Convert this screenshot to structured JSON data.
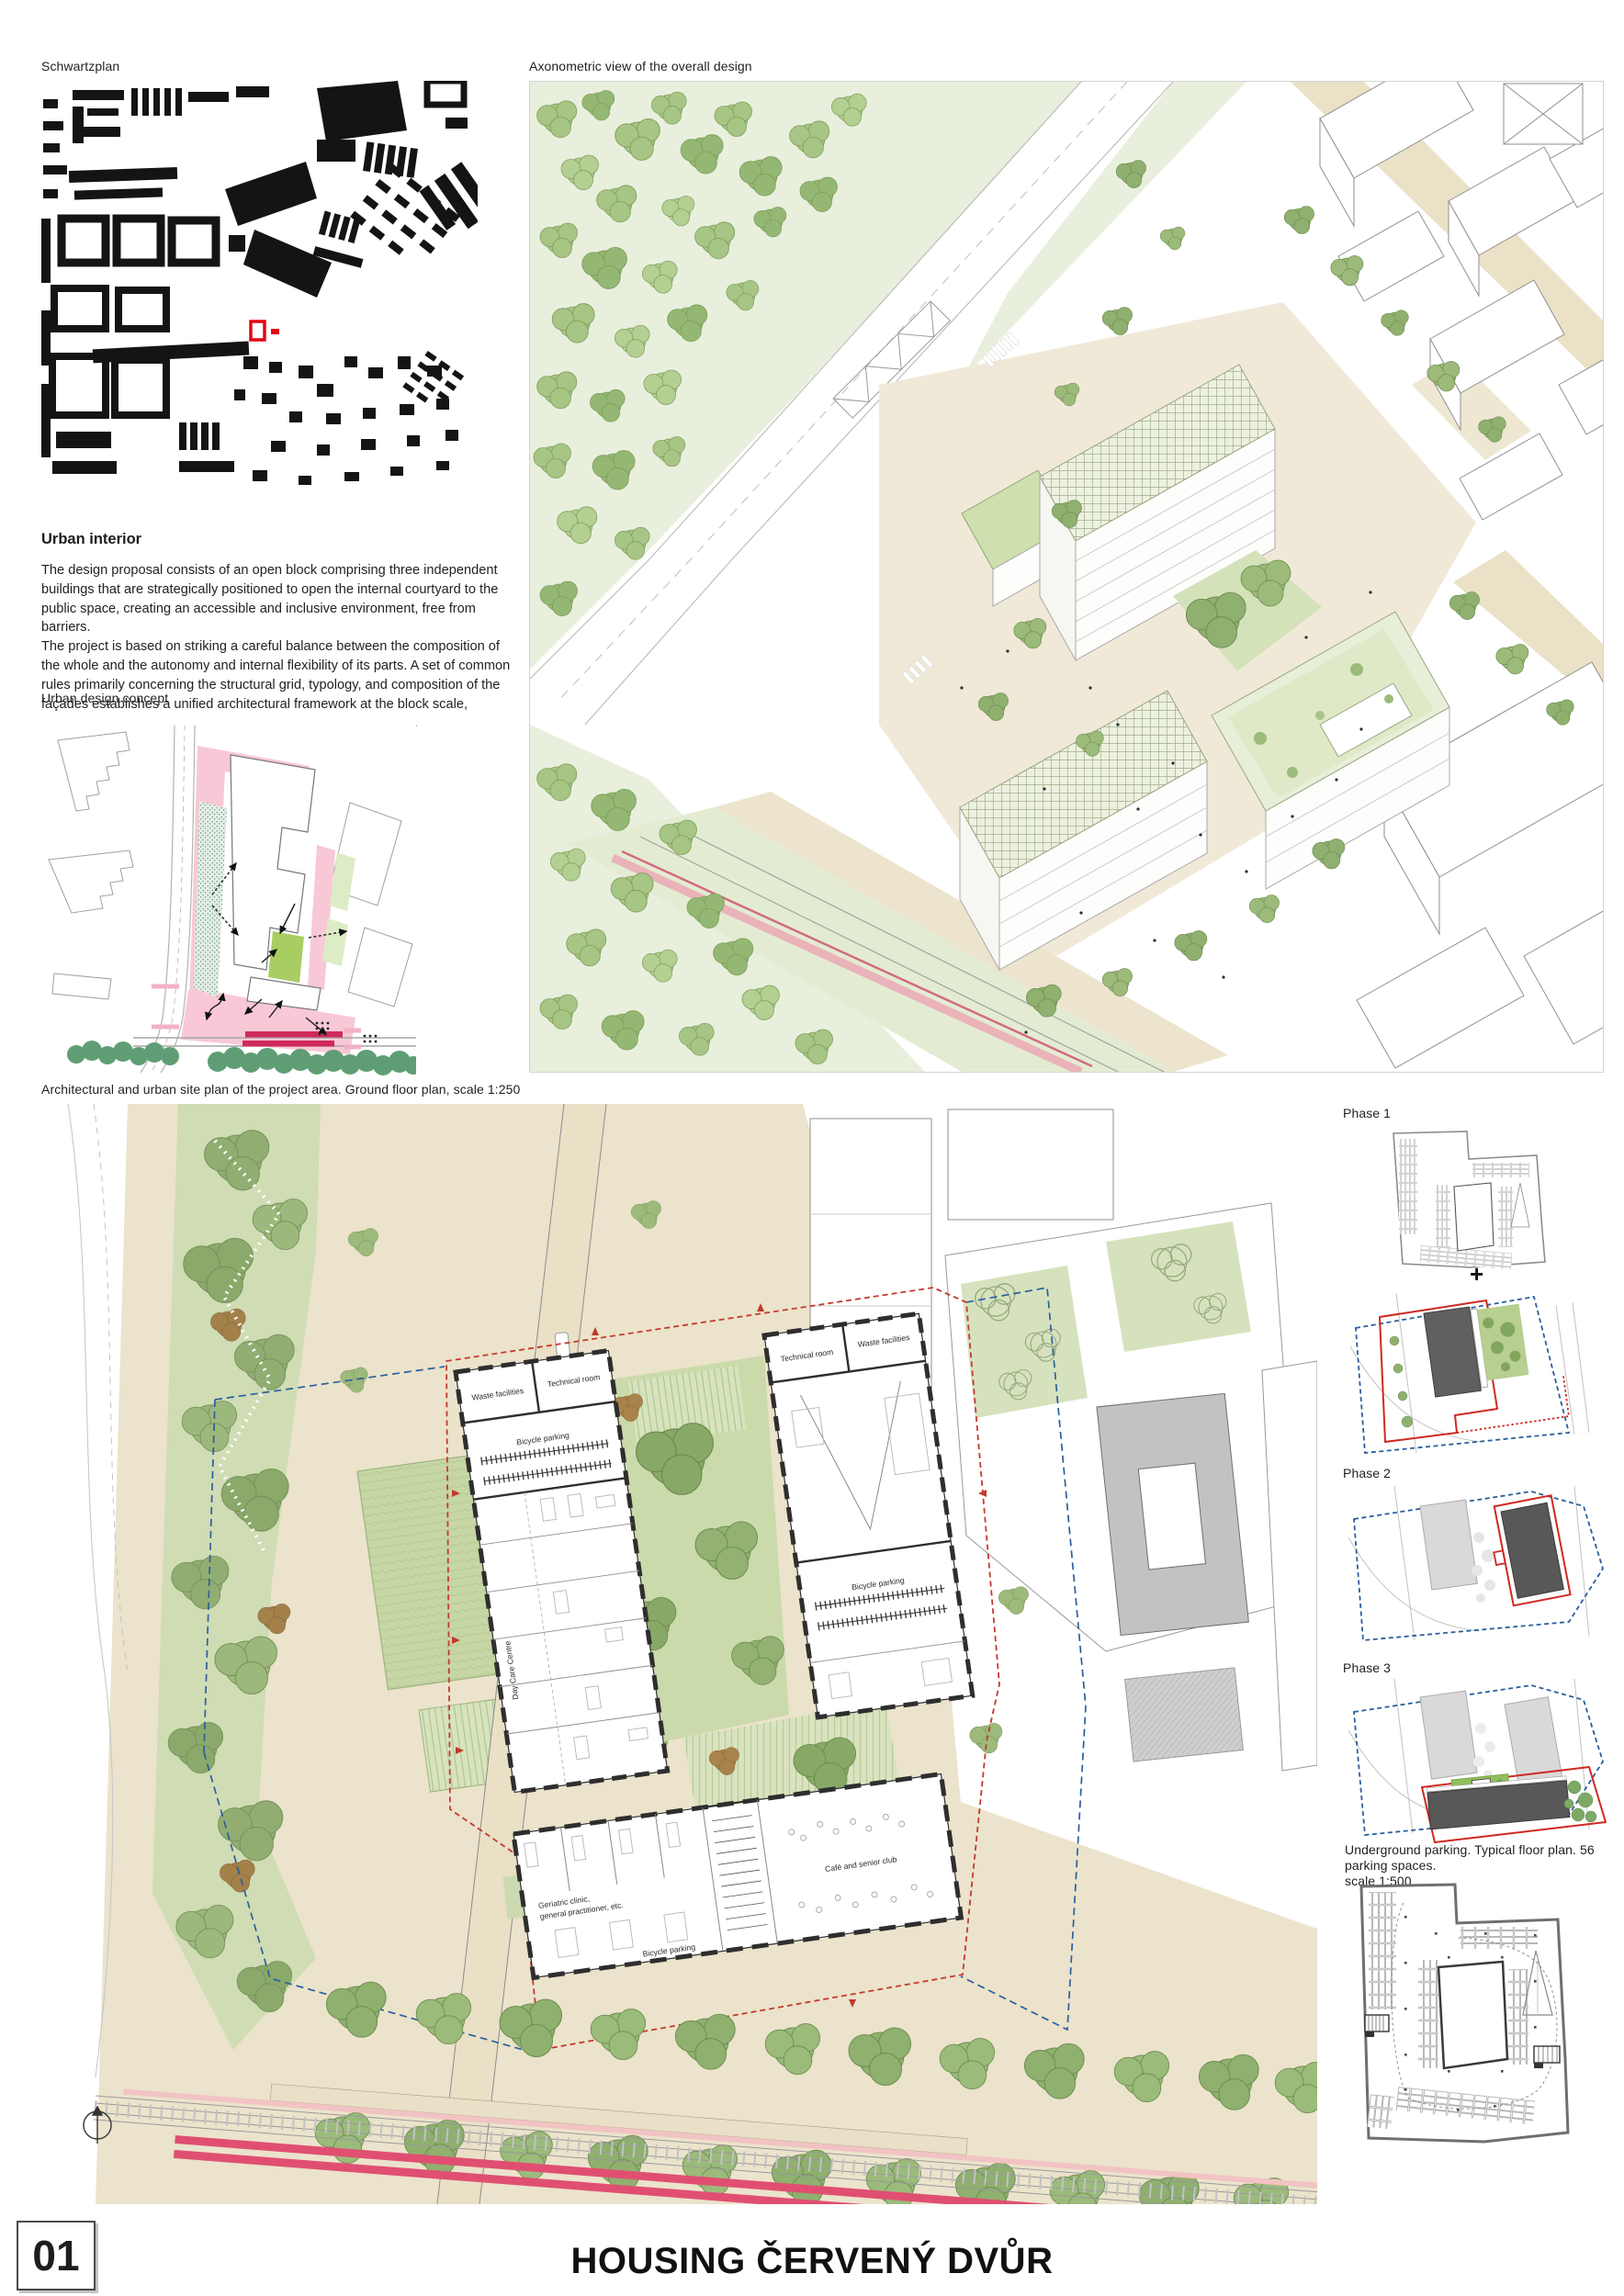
{
  "page": {
    "number": "01",
    "title": "HOUSING ČERVENÝ DVŮR"
  },
  "labels": {
    "schwartzplan": "Schwartzplan",
    "axonometric": "Axonometric view of the overall design",
    "urban_design_concept": "Urban design concept",
    "site_plan": "Architectural and urban site plan of the project area. Ground floor plan, scale 1:250",
    "phase1": "Phase 1",
    "phase1_plus": "+",
    "phase2": "Phase 2",
    "phase3": "Phase 3",
    "parking_caption_line1": "Underground parking. Typical floor plan. 56 parking spaces.",
    "parking_caption_line2": "scale 1:500"
  },
  "urban_interior": {
    "heading": "Urban interior",
    "paragraph1": "The design proposal consists of an open block comprising three independent buildings that are strategically positioned to open the internal courtyard to the public space, creating an accessible and inclusive environment, free from barriers.",
    "paragraph2": "The project is based on striking a careful balance between the composition of the whole and the autonomy and internal flexibility of its parts. A set of common rules primarily concerning the structural grid, typology, and composition of the façades establishes a unified architectural framework at the block scale, ensuring consistency throughout the three construction phases."
  },
  "site_plan": {
    "waste_a": "Waste facilities",
    "tech_a": "Technical room",
    "bike_a": "Bicycle parking",
    "daycare": "Day Care Centre",
    "tech_b": "Technical room",
    "waste_b": "Waste facilities",
    "bike_b": "Bicycle parking",
    "clinic1": "Geriatric clinic,",
    "clinic2": "general practitioner, etc.",
    "cafe": "Café and senior club",
    "bike_c": "Bicycle parking"
  },
  "colors": {
    "highlight_red": "#e30613",
    "boundary_red": "#cf2920",
    "boundary_blue": "#2b5f9e",
    "concept_pink": "#f8c8d6",
    "tram_magenta": "#cf2a5b",
    "park_green": "#cfdcb4",
    "tree_green": "#8fb06f",
    "dark_building": "#585858",
    "light_building": "#d9d9d9",
    "paving_beige": "#ebe3cb"
  }
}
